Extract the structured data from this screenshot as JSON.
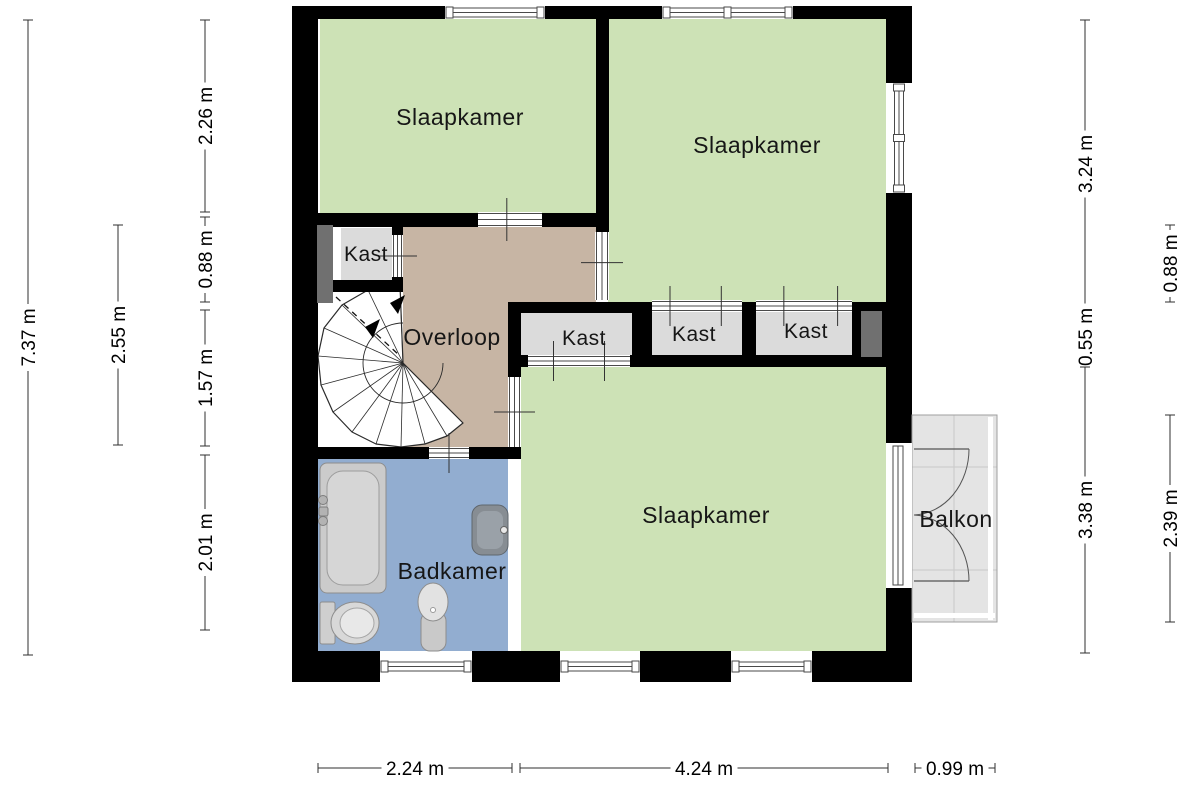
{
  "floorplan": {
    "colors": {
      "wall": "#000000",
      "line": "#4a4a4a",
      "green": "#cde2b6",
      "tan": "#c7b5a4",
      "blue": "#92add0",
      "kast": "#dbdbdb",
      "flue": "#707070",
      "balcony": "#e4e4e4",
      "balcony_line": "#c9c9c9",
      "fixture": "#cbcbcb",
      "fixture_stroke": "#8d8d8d",
      "dim": "#2f2f2f",
      "label": "#161616"
    },
    "rooms": [
      {
        "id": "slaapkamer-top-left",
        "label": "Slaapkamer",
        "fill": "green",
        "rect": [
          320,
          19,
          276,
          196
        ],
        "label_xy": [
          460,
          117
        ],
        "label_size": 23
      },
      {
        "id": "slaapkamer-top-right",
        "label": "Slaapkamer",
        "fill": "green",
        "rect": [
          608,
          19,
          278,
          283
        ],
        "label_xy": [
          757,
          145
        ],
        "label_size": 23
      },
      {
        "id": "slaapkamer-bottom",
        "label": "Slaapkamer",
        "fill": "green",
        "rect": [
          521,
          365,
          365,
          286
        ],
        "label_xy": [
          706,
          515
        ],
        "label_size": 23
      },
      {
        "id": "overloop-upper",
        "label": "",
        "fill": "tan",
        "rect": [
          403,
          225,
          193,
          77
        ]
      },
      {
        "id": "overloop",
        "label": "Overloop",
        "fill": "tan",
        "rect": [
          403,
          302,
          105,
          145
        ],
        "label_xy": [
          452,
          337
        ],
        "label_size": 23
      },
      {
        "id": "kast-links",
        "label": "Kast",
        "fill": "kast",
        "rect": [
          341,
          228,
          52,
          52
        ],
        "label_xy": [
          366,
          253
        ],
        "label_size": 21
      },
      {
        "id": "kast-1",
        "label": "Kast",
        "fill": "kast",
        "rect": [
          521,
          313,
          111,
          42
        ],
        "label_xy": [
          584,
          337
        ],
        "label_size": 21
      },
      {
        "id": "kast-2",
        "label": "Kast",
        "fill": "kast",
        "rect": [
          652,
          312,
          90,
          43
        ],
        "label_xy": [
          694,
          333
        ],
        "label_size": 21
      },
      {
        "id": "kast-3",
        "label": "Kast",
        "fill": "kast",
        "rect": [
          756,
          312,
          96,
          43
        ],
        "label_xy": [
          806,
          330
        ],
        "label_size": 21
      },
      {
        "id": "badkamer",
        "label": "Badkamer",
        "fill": "blue",
        "rect": [
          318,
          459,
          190,
          192
        ],
        "label_xy": [
          452,
          571
        ],
        "label_size": 23
      }
    ],
    "walls": [
      [
        292,
        6,
        620,
        13
      ],
      [
        292,
        6,
        26,
        676
      ],
      [
        292,
        651,
        620,
        31
      ],
      [
        886,
        6,
        26,
        676
      ],
      [
        596,
        19,
        13,
        213
      ],
      [
        318,
        213,
        278,
        14
      ],
      [
        318,
        280,
        85,
        12
      ],
      [
        392,
        226,
        11,
        56
      ],
      [
        508,
        302,
        129,
        11
      ],
      [
        508,
        302,
        13,
        75
      ],
      [
        508,
        355,
        378,
        12
      ],
      [
        632,
        302,
        20,
        65
      ],
      [
        742,
        302,
        14,
        65
      ],
      [
        852,
        302,
        34,
        65
      ],
      [
        318,
        447,
        203,
        12
      ]
    ],
    "flues": [
      [
        317,
        225,
        16,
        78
      ],
      [
        861,
        311,
        21,
        46
      ]
    ],
    "windows": [
      {
        "orient": "h",
        "x": 445,
        "y": 6,
        "len": 100,
        "th": 13
      },
      {
        "orient": "h",
        "x": 662,
        "y": 6,
        "len": 131,
        "th": 13,
        "mullion": 0.5
      },
      {
        "orient": "v",
        "x": 886,
        "y": 83,
        "len": 110,
        "th": 26,
        "mullion": 0.5
      },
      {
        "orient": "h",
        "x": 380,
        "y": 651,
        "len": 92,
        "th": 31
      },
      {
        "orient": "h",
        "x": 560,
        "y": 651,
        "len": 80,
        "th": 31
      },
      {
        "orient": "h",
        "x": 731,
        "y": 651,
        "len": 81,
        "th": 31
      }
    ],
    "doors": [
      {
        "id": "door-slaapkamer-top-left",
        "orient": "h",
        "x": 478,
        "y": 212,
        "w": 64,
        "h": 15,
        "ticks": [
          0.45
        ]
      },
      {
        "id": "door-slaapkamer-top-right",
        "orient": "v",
        "x": 595,
        "y": 232,
        "w": 14,
        "h": 68,
        "ticks": [
          0.45
        ]
      },
      {
        "id": "door-kast-links",
        "orient": "v",
        "x": 392,
        "y": 235,
        "w": 11,
        "h": 42,
        "ticks": [
          0.5
        ]
      },
      {
        "id": "door-slaapkamer-bottom",
        "orient": "v",
        "x": 508,
        "y": 377,
        "w": 13,
        "h": 70,
        "ticks": [
          0.5
        ]
      },
      {
        "id": "door-badkamer",
        "orient": "h",
        "x": 429,
        "y": 447,
        "w": 40,
        "h": 12,
        "ticks": [
          0.5
        ]
      },
      {
        "id": "kast1-sliding-doors",
        "orient": "h",
        "x": 528,
        "y": 355,
        "w": 102,
        "h": 12,
        "ticks": [
          0.25,
          0.75
        ]
      },
      {
        "id": "kast2-sliding-doors",
        "orient": "h",
        "x": 652,
        "y": 300,
        "w": 90,
        "h": 12,
        "ticks": [
          0.2,
          0.77
        ]
      },
      {
        "id": "kast3-sliding-doors",
        "orient": "h",
        "x": 756,
        "y": 300,
        "w": 96,
        "h": 12,
        "ticks": [
          0.29,
          0.85
        ]
      }
    ],
    "balcony_door": {
      "x": 886,
      "y": 443,
      "w": 26,
      "h": 145,
      "leaf_len": 57,
      "meet_y": 515
    },
    "balcony": {
      "label": "Balkon",
      "rect": [
        912,
        415,
        85,
        207
      ],
      "label_xy": [
        956,
        519
      ],
      "label_size": 23,
      "grid_x": [
        954
      ],
      "grid_y": [
        467,
        570
      ]
    },
    "stairs": {
      "area": [
        318,
        292,
        85,
        155
      ],
      "center": [
        403,
        363
      ],
      "inner_r": 40,
      "fan": [
        [
          400,
          285
        ],
        [
          368,
          290
        ],
        [
          342,
          305
        ],
        [
          324,
          328
        ],
        [
          318,
          356
        ],
        [
          321,
          385
        ],
        [
          333,
          412
        ],
        [
          352,
          432
        ],
        [
          376,
          444
        ],
        [
          401,
          447
        ],
        [
          425,
          444
        ],
        [
          447,
          436
        ],
        [
          463,
          423
        ]
      ],
      "dash": [
        [
          336,
          297
        ],
        [
          399,
          355
        ]
      ],
      "arrows": [
        [
          [
            390,
            303
          ],
          [
            405,
            295
          ],
          [
            398,
            314
          ]
        ],
        [
          [
            365,
            327
          ],
          [
            380,
            319
          ],
          [
            373,
            338
          ]
        ]
      ]
    },
    "fixtures": {
      "bathtub": {
        "outer": [
          320,
          463,
          66,
          130
        ],
        "inner": [
          327,
          471,
          52,
          114
        ],
        "knobs": [
          [
            323,
            500
          ],
          [
            323,
            521
          ]
        ],
        "spout": [
          319,
          507,
          9,
          9
        ]
      },
      "toilet": {
        "tank": [
          320,
          602,
          15,
          42
        ],
        "bowl": [
          355,
          623,
          24,
          21
        ],
        "bowl_inner": [
          357,
          623,
          17,
          15
        ]
      },
      "pedestal_sink": {
        "stand": [
          421,
          612,
          25,
          39
        ],
        "bowl": [
          433,
          602,
          15,
          19
        ],
        "dot": [
          433,
          610
        ]
      },
      "wall_basin": {
        "outer": [
          472,
          505,
          36,
          50
        ],
        "inner": [
          477,
          511,
          26,
          38
        ],
        "faucet": [
          504,
          530
        ]
      }
    },
    "dimensions": [
      {
        "text": "7.37 m",
        "orient": "v",
        "pos": 28,
        "from": 20,
        "to": 655
      },
      {
        "text": "2.55 m",
        "orient": "v",
        "pos": 118,
        "from": 225,
        "to": 445
      },
      {
        "text": "2.26 m",
        "orient": "v",
        "pos": 205,
        "from": 20,
        "to": 212
      },
      {
        "text": "0.88 m",
        "orient": "v",
        "pos": 205,
        "from": 217,
        "to": 302
      },
      {
        "text": "1.57 m",
        "orient": "v",
        "pos": 205,
        "from": 310,
        "to": 446
      },
      {
        "text": "2.01 m",
        "orient": "v",
        "pos": 205,
        "from": 455,
        "to": 630
      },
      {
        "text": "3.24 m",
        "orient": "v",
        "pos": 1085,
        "from": 20,
        "to": 308
      },
      {
        "text": "0.55 m",
        "orient": "v",
        "pos": 1085,
        "from": 313,
        "to": 361
      },
      {
        "text": "3.38 m",
        "orient": "v",
        "pos": 1085,
        "from": 367,
        "to": 653
      },
      {
        "text": "0.88 m",
        "orient": "v",
        "pos": 1170,
        "from": 225,
        "to": 302
      },
      {
        "text": "2.39 m",
        "orient": "v",
        "pos": 1170,
        "from": 415,
        "to": 622
      },
      {
        "text": "2.24 m",
        "orient": "h",
        "pos": 768,
        "from": 318,
        "to": 512
      },
      {
        "text": "4.24 m",
        "orient": "h",
        "pos": 768,
        "from": 520,
        "to": 888
      },
      {
        "text": "0.99 m",
        "orient": "h",
        "pos": 768,
        "from": 915,
        "to": 995
      }
    ]
  }
}
